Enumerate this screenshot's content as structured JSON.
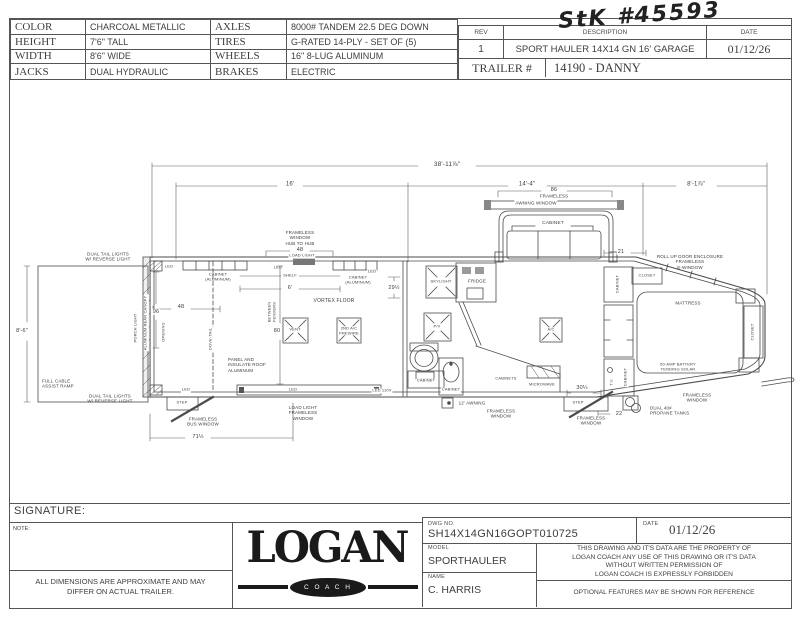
{
  "stk_note": "StK #45593",
  "spec_table": {
    "rows": [
      {
        "l1": "COLOR",
        "v1": "CHARCOAL METALLIC",
        "l2": "AXLES",
        "v2": "8000# TANDEM 22.5 DEG DOWN"
      },
      {
        "l1": "HEIGHT",
        "v1": "7'6\" TALL",
        "l2": "TIRES",
        "v2": "G-RATED 14-PLY - SET OF (5)"
      },
      {
        "l1": "WIDTH",
        "v1": "8'6\" WIDE",
        "l2": "WHEELS",
        "v2": "16\" 8-LUG ALUMINUM"
      },
      {
        "l1": "JACKS",
        "v1": "DUAL HYDRAULIC",
        "l2": "BRAKES",
        "v2": "ELECTRIC"
      }
    ]
  },
  "rev_table": {
    "headers": [
      "REV",
      "DESCRIPTION",
      "DATE"
    ],
    "rev": "1",
    "description": "SPORT HAULER 14X14 GN 16' GARAGE",
    "date": "01/12/26",
    "trailer_label": "TRAILER #",
    "trailer_number": "14190 - DANNY"
  },
  "plan": {
    "labels": [
      {
        "t": "38'-11⅞\"",
        "x": 447,
        "y": 165,
        "s": 6.5,
        "bg": 1
      },
      {
        "t": "16'",
        "x": 290,
        "y": 185,
        "s": 6,
        "bg": 1
      },
      {
        "t": "14'-4\"",
        "x": 527,
        "y": 185,
        "s": 6,
        "bg": 1
      },
      {
        "t": "8'-1⅞\"",
        "x": 696,
        "y": 185,
        "s": 6,
        "bg": 1
      },
      {
        "t": "86",
        "x": 554,
        "y": 190,
        "s": 5.5,
        "bg": 1
      },
      {
        "t": "FRAMELESS",
        "x": 554,
        "y": 196,
        "s": 4.5,
        "bg": 1
      },
      {
        "t": "AWNING  WINDOW",
        "x": 536,
        "y": 203,
        "s": 4.5,
        "bg": 1
      },
      {
        "t": "CABINET",
        "x": 553,
        "y": 224,
        "s": 4.8,
        "bg": 1
      },
      {
        "t": "21",
        "x": 621,
        "y": 252,
        "s": 5.5,
        "bg": 1
      },
      {
        "t": "ROLL UP DOOR ENCLOSURE\nFRAMELESS\nE-WINDOW",
        "x": 690,
        "y": 262,
        "s": 4.5
      },
      {
        "t": "8'-6\"",
        "x": 22,
        "y": 331,
        "s": 5.5,
        "bg": 1
      },
      {
        "t": "DUAL TAIL LIGHTS\nW/ REVERSE LIGHT",
        "x": 108,
        "y": 257,
        "s": 4.5
      },
      {
        "t": "DUAL TAIL LIGHTS\nW/ REVERSE LIGHT",
        "x": 110,
        "y": 399,
        "s": 4.5
      },
      {
        "t": "FULL CABLE\nASSIST RAMP",
        "x": 42,
        "y": 384,
        "s": 4.5,
        "a": "l"
      },
      {
        "t": "PORCH LIGHT",
        "x": 136,
        "y": 328,
        "s": 4,
        "r": -90
      },
      {
        "t": "ALUMINUM REAR CANOPY",
        "x": 146,
        "y": 323,
        "s": 4,
        "r": -90,
        "bg": 1
      },
      {
        "t": "LED",
        "x": 169,
        "y": 267,
        "s": 4
      },
      {
        "t": "CABINET\n(ALUMINUM)",
        "x": 218,
        "y": 277,
        "s": 4
      },
      {
        "t": "LED",
        "x": 278,
        "y": 268,
        "s": 4
      },
      {
        "t": "SHELF",
        "x": 290,
        "y": 276,
        "s": 4,
        "bg": 1
      },
      {
        "t": "6'",
        "x": 290,
        "y": 288,
        "s": 5.5,
        "bg": 1
      },
      {
        "t": "LED",
        "x": 372,
        "y": 272,
        "s": 4,
        "bg": 1
      },
      {
        "t": "CABINET\n(ALUMINUM)",
        "x": 358,
        "y": 280,
        "s": 4,
        "bg": 1
      },
      {
        "t": "FRAMELESS\nWINDOW\nHUB TO HUB",
        "x": 300,
        "y": 238,
        "s": 4.5
      },
      {
        "t": "48",
        "x": 300,
        "y": 250,
        "s": 5.5,
        "bg": 1
      },
      {
        "t": "LOAD LIGHT",
        "x": 302,
        "y": 256,
        "s": 4,
        "bg": 1
      },
      {
        "t": "96",
        "x": 156,
        "y": 312,
        "s": 5.5,
        "bg": 1
      },
      {
        "t": "48",
        "x": 181,
        "y": 307,
        "s": 5.5,
        "bg": 1
      },
      {
        "t": "OPENING",
        "x": 164,
        "y": 332,
        "s": 4,
        "r": -90
      },
      {
        "t": "DOVE-TAIL",
        "x": 211,
        "y": 339,
        "s": 4,
        "r": -90,
        "bg": 1
      },
      {
        "t": "VORTEX FLOOR",
        "x": 334,
        "y": 302,
        "s": 5
      },
      {
        "t": "BETWEEN\nFENDERS",
        "x": 272,
        "y": 312,
        "s": 4,
        "r": -90,
        "bg": 1
      },
      {
        "t": "80",
        "x": 277,
        "y": 331,
        "s": 5.5,
        "bg": 1
      },
      {
        "t": "VENT",
        "x": 295,
        "y": 330,
        "s": 4,
        "bg": 1
      },
      {
        "t": "2ND A/C\nPREWIRE",
        "x": 349,
        "y": 331,
        "s": 4,
        "bg": 1
      },
      {
        "t": "PANEL AND\nINSULATE ROOF\nALUMINUM",
        "x": 228,
        "y": 365,
        "s": 4.5,
        "a": "l"
      },
      {
        "t": "LED",
        "x": 186,
        "y": 390,
        "s": 4,
        "bg": 1
      },
      {
        "t": "STEP",
        "x": 182,
        "y": 403,
        "s": 4
      },
      {
        "t": "FRAMELESS\nBUS WINDOW",
        "x": 203,
        "y": 422,
        "s": 4.5
      },
      {
        "t": "71½",
        "x": 198,
        "y": 437,
        "s": 5.5,
        "bg": 1
      },
      {
        "t": "LED",
        "x": 293,
        "y": 390,
        "s": 4
      },
      {
        "t": "LED 110V",
        "x": 382,
        "y": 391,
        "s": 4,
        "bg": 1
      },
      {
        "t": "LOAD LIGHT\nFRAMELESS\nWINDOW",
        "x": 303,
        "y": 413,
        "s": 4.5
      },
      {
        "t": "29½",
        "x": 394,
        "y": 288,
        "s": 5.5,
        "bg": 1
      },
      {
        "t": "SKYLIGHT",
        "x": 441,
        "y": 282,
        "s": 4,
        "bg": 1
      },
      {
        "t": "FRIDGE",
        "x": 477,
        "y": 281,
        "s": 4.5,
        "bg": 1
      },
      {
        "t": "P/V",
        "x": 437,
        "y": 327,
        "s": 4,
        "bg": 1
      },
      {
        "t": "CABINET",
        "x": 426,
        "y": 381,
        "s": 4,
        "bg": 1
      },
      {
        "t": "CABINET",
        "x": 451,
        "y": 390,
        "s": 4,
        "bg": 1
      },
      {
        "t": "CABINETS",
        "x": 506,
        "y": 379,
        "s": 4,
        "bg": 1
      },
      {
        "t": "MICROWAVE",
        "x": 542,
        "y": 385,
        "s": 4,
        "bg": 1
      },
      {
        "t": "12' AWNING",
        "x": 472,
        "y": 403,
        "s": 4.5
      },
      {
        "t": "FRAMELESS\nWINDOW",
        "x": 501,
        "y": 414,
        "s": 4.5
      },
      {
        "t": "A/C",
        "x": 551,
        "y": 330,
        "s": 4,
        "bg": 1
      },
      {
        "t": "CLOSET",
        "x": 647,
        "y": 276,
        "s": 4,
        "bg": 1
      },
      {
        "t": "CABINET",
        "x": 618,
        "y": 284,
        "s": 4,
        "r": -90,
        "bg": 1
      },
      {
        "t": "MATTRESS",
        "x": 688,
        "y": 303,
        "s": 4.5
      },
      {
        "t": "50-AMP BATTERY\nTENDING SOLAR",
        "x": 678,
        "y": 367,
        "s": 4
      },
      {
        "t": "CLOSET",
        "x": 753,
        "y": 332,
        "s": 4,
        "r": -90,
        "bg": 1
      },
      {
        "t": "T.V.",
        "x": 612,
        "y": 382,
        "s": 4,
        "r": -90,
        "bg": 1
      },
      {
        "t": "CABINET",
        "x": 626,
        "y": 377,
        "s": 4,
        "r": -90,
        "bg": 1
      },
      {
        "t": "STEP",
        "x": 578,
        "y": 403,
        "s": 4
      },
      {
        "t": "30¼",
        "x": 582,
        "y": 388,
        "s": 5.5,
        "bg": 1
      },
      {
        "t": "FRAMELESS\nWINDOW",
        "x": 591,
        "y": 421,
        "s": 4.5,
        "bg": 1
      },
      {
        "t": "22",
        "x": 619,
        "y": 414,
        "s": 5.5,
        "bg": 1
      },
      {
        "t": "FRAMELESS\nWINDOW",
        "x": 697,
        "y": 398,
        "s": 4.5
      },
      {
        "t": "DUAL 40#\nPROPANE TANKS",
        "x": 650,
        "y": 411,
        "s": 4.5,
        "a": "l"
      }
    ]
  },
  "footer": {
    "signature_label": "SIGNATURE:",
    "note_label": "NOTE:",
    "disclaimer": "ALL DIMENSIONS ARE APPROXIMATE AND MAY\nDIFFER ON ACTUAL TRAILER.",
    "logo_text": "LOGAN",
    "logo_sub": "C O A C H",
    "dwg_no_label": "DWG  NO.",
    "dwg_no": "SH14X14GN16GOPT010725",
    "date_label": "DATE",
    "date": "01/12/26",
    "model_label": "MODEL",
    "model": "SPORTHAULER",
    "name_label": "NAME",
    "name": "C. HARRIS",
    "legal": "THIS DRAWING AND IT'S DATA ARE THE PROPERTY OF\nLOGAN COACH ANY USE OF THIS DRAWING OR IT'S DATA\nWITHOUT WRITTEN PERMISSION OF\nLOGAN COACH IS EXPRESSLY FORBIDDEN",
    "optional_note": "OPTIONAL FEATURES MAY BE SHOWN FOR REFERENCE"
  }
}
